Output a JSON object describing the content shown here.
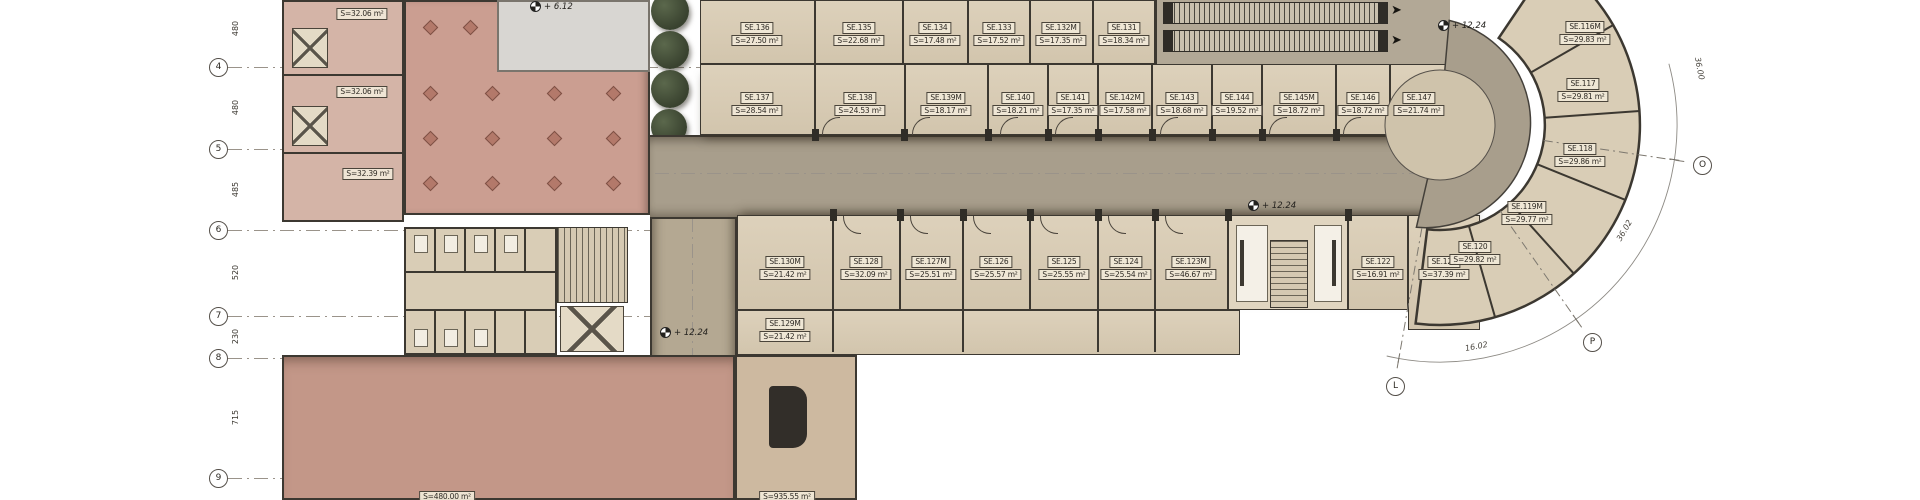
{
  "title": "floor-plan",
  "grid": {
    "bubbles": [
      "4",
      "5",
      "6",
      "7",
      "8",
      "9"
    ],
    "dims": [
      "480",
      "480",
      "485",
      "520",
      "230",
      "715"
    ],
    "radial_bubbles": [
      "O",
      "P",
      "L"
    ],
    "radial_dims": [
      "36.00",
      "36.02",
      "16.02"
    ]
  },
  "levels": {
    "upper_left": "+ 6.12",
    "escalator": "+ 12.24",
    "core": "+ 12.24",
    "lobby": "+ 12.24"
  },
  "rooms": {
    "row1": [
      {
        "name": "SE.136",
        "area": "S=27.50 m²"
      },
      {
        "name": "SE.135",
        "area": "S=22.68 m²"
      },
      {
        "name": "SE.134",
        "area": "S=17.48 m²"
      },
      {
        "name": "SE.133",
        "area": "S=17.52 m²"
      },
      {
        "name": "SE.132M",
        "area": "S=17.35 m²"
      },
      {
        "name": "SE.131",
        "area": "S=18.34 m²"
      }
    ],
    "row2": [
      {
        "name": "SE.137",
        "area": "S=28.54 m²"
      },
      {
        "name": "SE.138",
        "area": "S=24.53 m²"
      },
      {
        "name": "SE.139M",
        "area": "S=18.17 m²"
      },
      {
        "name": "SE.140",
        "area": "S=18.21 m²"
      },
      {
        "name": "SE.141",
        "area": "S=17.35 m²"
      },
      {
        "name": "SE.142M",
        "area": "S=17.58 m²"
      },
      {
        "name": "SE.143",
        "area": "S=18.68 m²"
      },
      {
        "name": "SE.144",
        "area": "S=19.52 m²"
      },
      {
        "name": "SE.145M",
        "area": "S=18.72 m²"
      },
      {
        "name": "SE.146",
        "area": "S=18.72 m²"
      },
      {
        "name": "SE.147",
        "area": "S=21.74 m²"
      }
    ],
    "row3": [
      {
        "name": "SE.130M",
        "area": "S=21.42 m²"
      },
      {
        "name": "SE.128",
        "area": "S=32.09 m²"
      },
      {
        "name": "SE.127M",
        "area": "S=25.51 m²"
      },
      {
        "name": "SE.126",
        "area": "S=25.57 m²"
      },
      {
        "name": "SE.125",
        "area": "S=25.55 m²"
      },
      {
        "name": "SE.124",
        "area": "S=25.54 m²"
      },
      {
        "name": "SE.123M",
        "area": "S=46.67 m²"
      },
      {
        "name": "SE.122",
        "area": "S=16.91 m²"
      },
      {
        "name": "SE.121",
        "area": "S=37.39 m²"
      }
    ],
    "mezzanine": {
      "name": "SE.129M",
      "area": "S=21.42 m²"
    },
    "curve": [
      {
        "name": "SE.120",
        "area": "S=29.82 m²"
      },
      {
        "name": "SE.119M",
        "area": "S=29.77 m²"
      },
      {
        "name": "SE.118",
        "area": "S=29.86 m²"
      },
      {
        "name": "SE.117",
        "area": "S=29.81 m²"
      },
      {
        "name": "SE.116M",
        "area": "S=29.83 m²"
      }
    ]
  },
  "left_wing": {
    "areas": [
      "S=32.06 m²",
      "S=32.06 m²",
      "S=32.39 m²"
    ]
  },
  "halls": [
    {
      "area": "S=480.00 m²"
    },
    {
      "area": "S=935.55 m²"
    }
  ],
  "colors": {
    "room_fill": "#d9cdb6",
    "corridor": "#a89e8c",
    "service_pink": "#d4b4a7",
    "courtyard": "#cb9e91",
    "hall": "#c39788",
    "wall": "#3c3831",
    "tree": "#39422f"
  }
}
